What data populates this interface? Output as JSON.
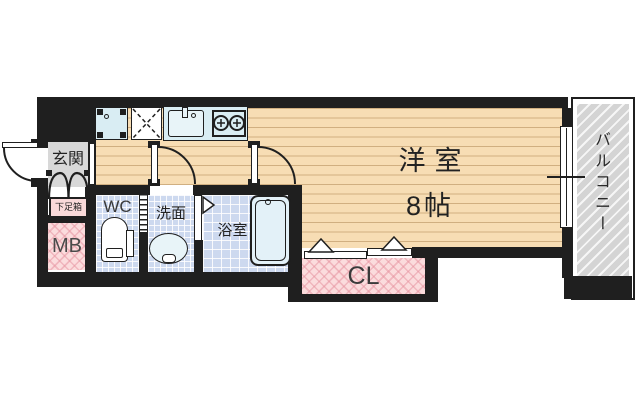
{
  "rooms": {
    "entrance": "玄関",
    "shoe_cabinet": "下足箱",
    "meter_box": "MB",
    "toilet": "WC",
    "washroom": "洗面",
    "bathroom": "浴室",
    "western_room": "洋室",
    "western_room_size": "8帖",
    "closet": "CL",
    "balcony": "バルコニー"
  },
  "colors": {
    "wall": "#1f1f1f",
    "wood_floor": "#f7ddb4",
    "entrance_floor": "#d8d8d8",
    "wet_area_tile": "#cdd9ef",
    "fixture_blue": "#d9edf3",
    "storage_pink": "#fbdcdd",
    "balcony_gray": "#d4d4d4",
    "text": "#222222"
  }
}
